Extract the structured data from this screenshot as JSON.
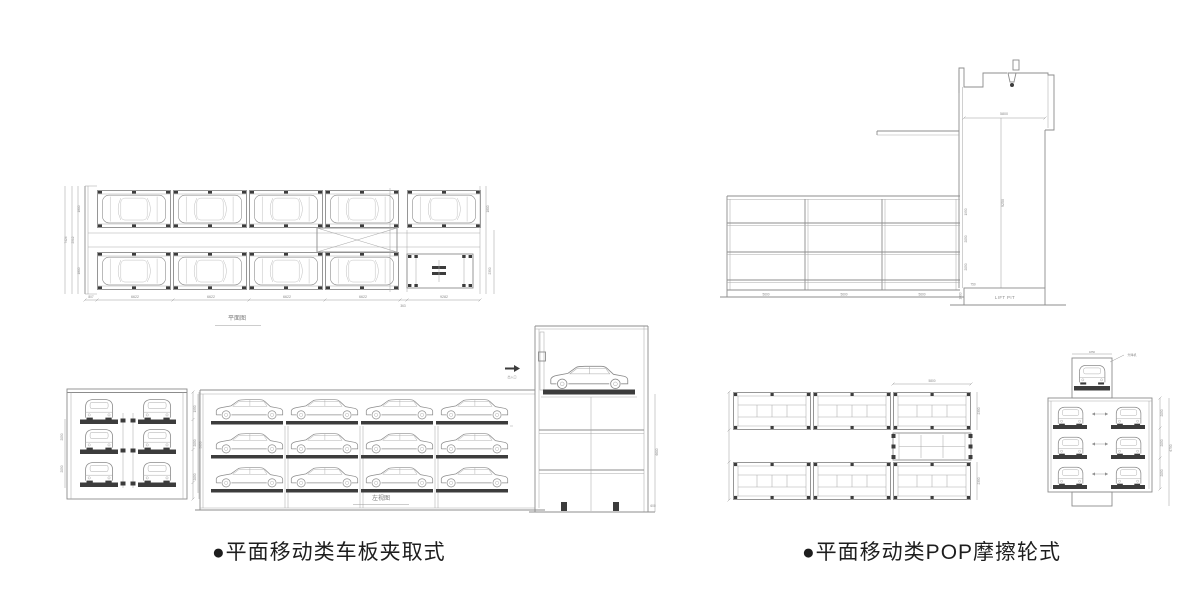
{
  "captions": {
    "left": "●平面移动类车板夹取式",
    "right": "●平面移动类POP摩擦轮式"
  },
  "plan_view": {
    "caption": "平面图",
    "dim_left_edge": "807",
    "dim_bays": [
      "6622",
      "6622",
      "6622",
      "6622"
    ],
    "dim_lift_bay": "9282",
    "dim_gap": "363",
    "dim_row_top": "1800",
    "dim_aisle": "2512",
    "dim_row_bottom": "1800",
    "dim_total_height": "7424",
    "dim_right_top": "1800",
    "dim_lift_width": "2350"
  },
  "section_view": {
    "dim_shaft_width": "5800",
    "dim_shaft_height": "9250",
    "pit_label": "LIFT PIT",
    "dim_pit_offset": "750",
    "dim_pit_depth": "1000",
    "dim_levels": [
      "1950",
      "2050",
      "2050"
    ],
    "dim_bays": [
      "5600",
      "5600",
      "5600"
    ]
  },
  "end_view": {
    "dim_levels": [
      "2050",
      "2050"
    ],
    "dim_height": "5850"
  },
  "side_view": {
    "caption": "左视图",
    "dim_levels": [
      "1950",
      "2050",
      "2050"
    ],
    "entry_label": "出入口",
    "dim_tower": "6600",
    "dim_pit": "600"
  },
  "pallet_plan": {
    "dim_top": "5800",
    "dim_rows": [
      "2350",
      "2350"
    ]
  },
  "lift_view": {
    "hoist_label": "升降机",
    "dim_top": "1850",
    "dim_levels": [
      "2050",
      "2050",
      "2050"
    ],
    "dim_height": "6750"
  }
}
